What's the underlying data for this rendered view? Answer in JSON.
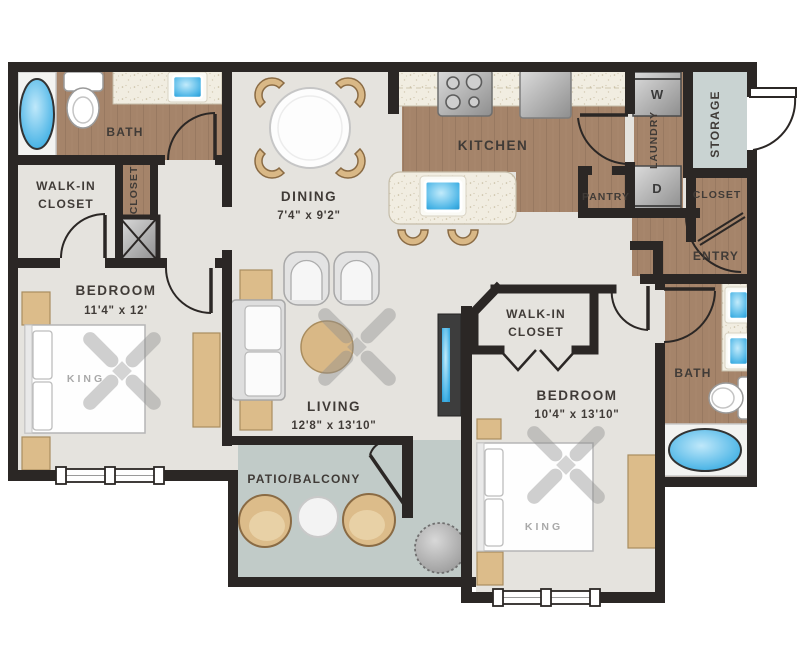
{
  "plan": {
    "type": "apartment-floor-plan",
    "rooms": {
      "bath1": {
        "name": "BATH"
      },
      "walk_in_closet_1": {
        "line1": "WALK-IN",
        "line2": "CLOSET"
      },
      "hall_closet": {
        "name": "CLOSET"
      },
      "bedroom1": {
        "name": "BEDROOM",
        "dims": "11'4\" x 12'",
        "bed": "KING"
      },
      "dining": {
        "name": "DINING",
        "dims": "7'4\" x 9'2\""
      },
      "kitchen": {
        "name": "KITCHEN"
      },
      "laundry": {
        "name": "LAUNDRY",
        "washer": "W",
        "dryer": "D"
      },
      "storage": {
        "name": "STORAGE"
      },
      "pantry": {
        "name": "PANTRY"
      },
      "entry_closet": {
        "name": "CLOSET"
      },
      "entry": {
        "name": "ENTRY"
      },
      "walk_in_closet_2": {
        "line1": "WALK-IN",
        "line2": "CLOSET"
      },
      "bedroom2": {
        "name": "BEDROOM",
        "dims": "10'4\" x 13'10\"",
        "bed": "KING"
      },
      "bath2": {
        "name": "BATH"
      },
      "living": {
        "name": "LIVING",
        "dims": "12'8\" x 13'10\""
      },
      "patio": {
        "name": "PATIO/BALCONY"
      }
    },
    "colors": {
      "wall": "#2b2725",
      "wood_floor": "#a5846a",
      "interior_floor": "#e5e3de",
      "outdoor_floor": "#c1cbc8",
      "counter_speckle": "#f1ede1",
      "water_blue": "#45b2e5",
      "furniture_tan": "#dcbc8a",
      "furniture_gray": "#e3e3e3",
      "label_text": "#403b37"
    }
  }
}
